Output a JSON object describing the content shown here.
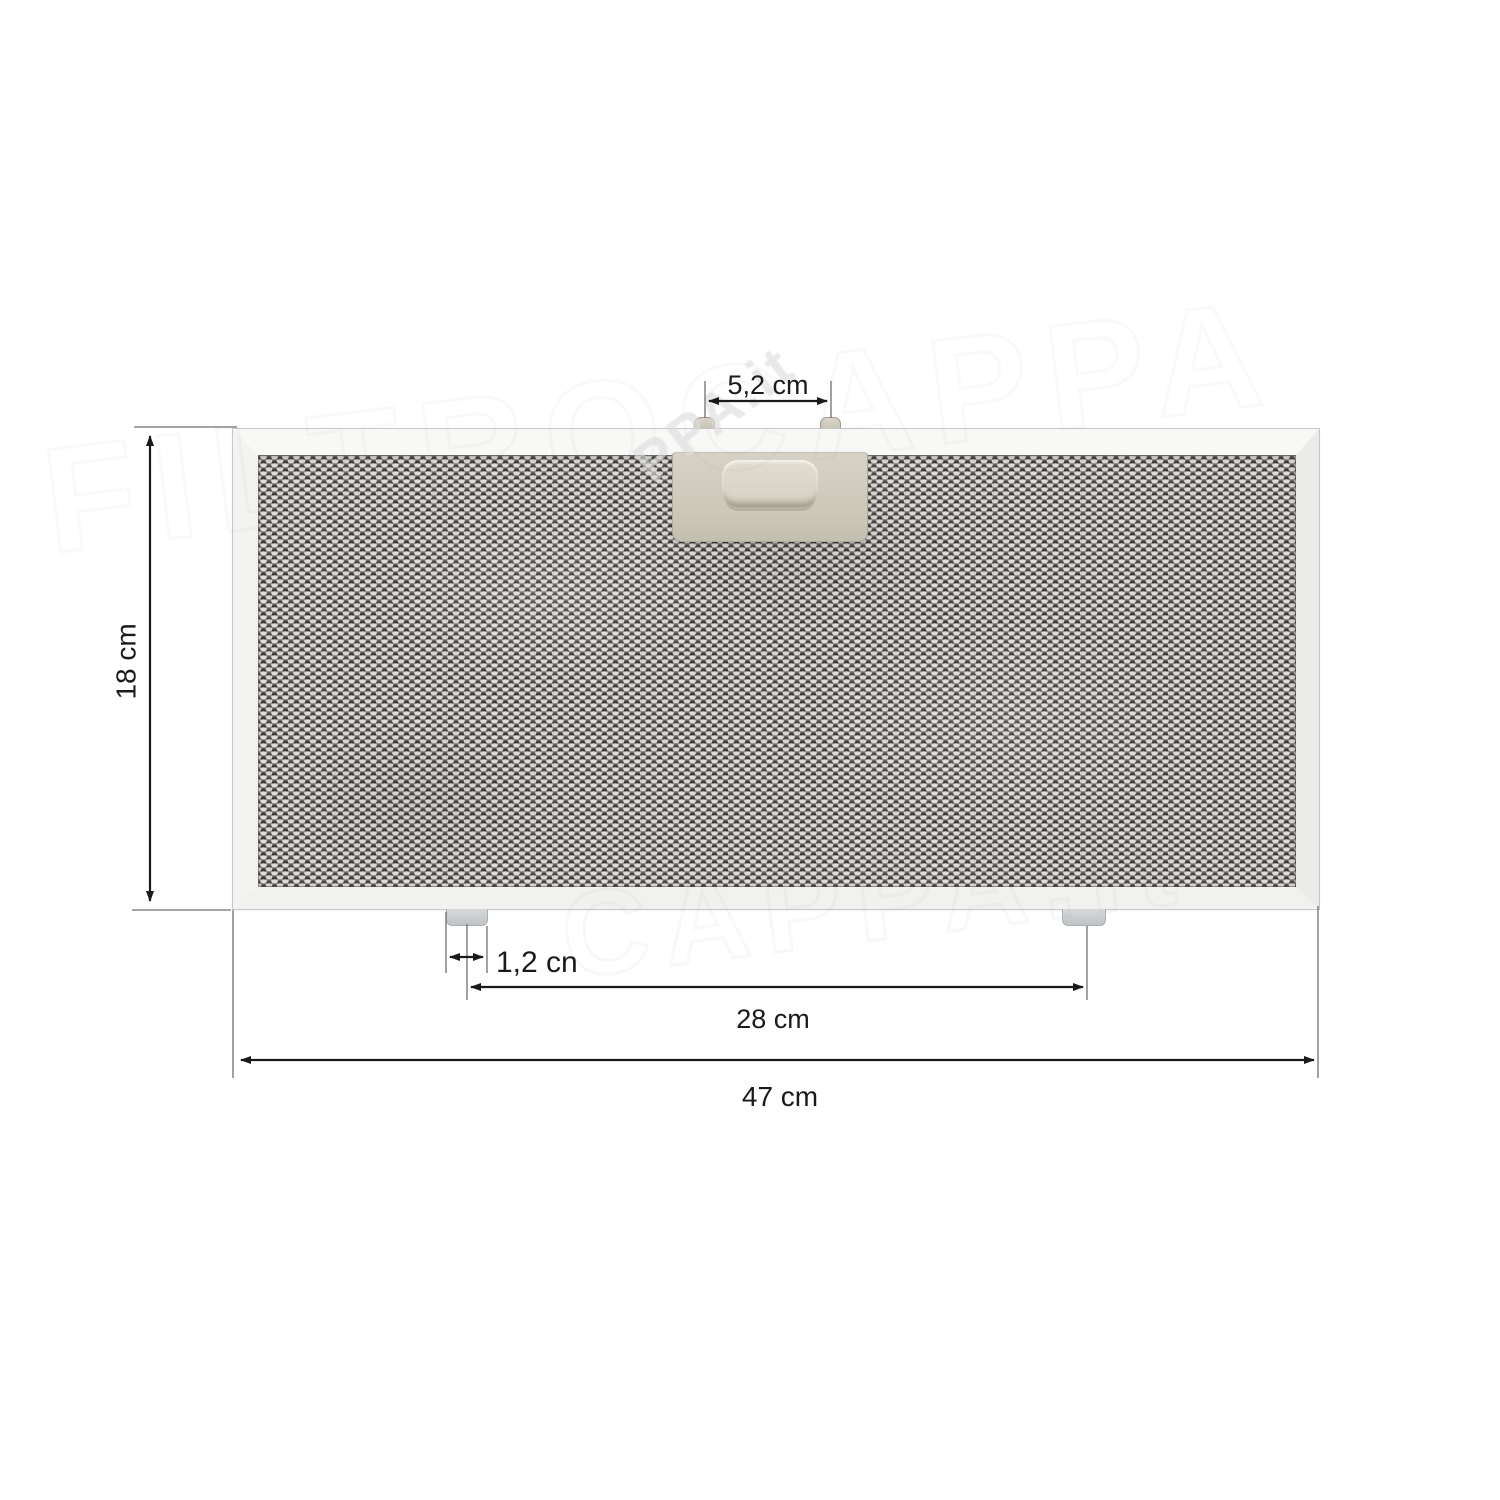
{
  "diagram": {
    "dimensions": {
      "height_label": "18 cm",
      "top_pin_spacing_label": "5,2 cm",
      "bottom_tab_width_label": "1,2 cn",
      "bottom_tab_spacing_label": "28 cm",
      "total_width_label": "47 cm"
    },
    "watermark": {
      "primary": "PPA.it",
      "faint_top": "FILTROCAPPA",
      "faint_bottom": "CAPPA.it"
    },
    "colors": {
      "background": "#ffffff",
      "frame": "#f4f4f3",
      "mesh_base": "#8d8b89",
      "mesh_dark": "#3b3a38",
      "mesh_light": "#e0ddd9",
      "latch": "#cdc9bb",
      "bottom_tab": "#cbcfd1",
      "dimension_line": "#1a1a1a"
    }
  }
}
